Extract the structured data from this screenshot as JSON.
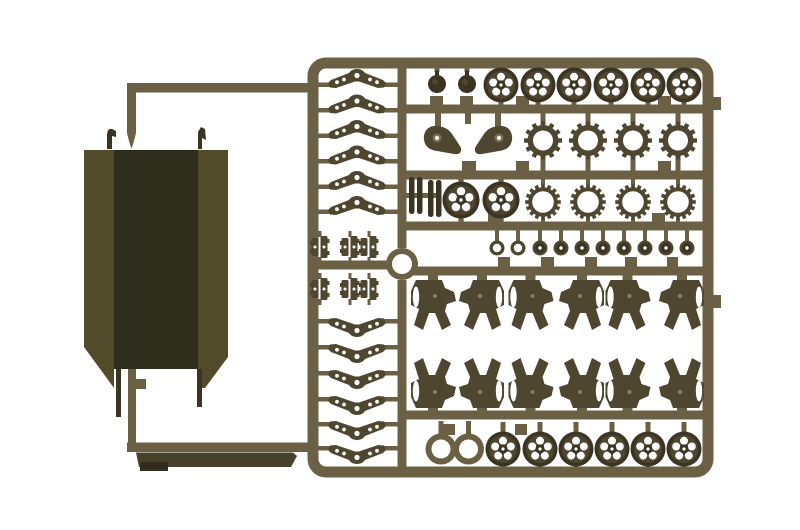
{
  "scene": {
    "description": "Photograph of an olive-drab injection-molded model kit sprue (parts tree) holding tank running-gear parts, with a separate dark hull tub attached to the frame by feed runners on a white background",
    "background_color": "#ffffff"
  },
  "colors": {
    "background": "#ffffff",
    "runner": "#6b6044",
    "runner_light": "#7b7052",
    "part": "#4f4630",
    "part_dark": "#3c3422",
    "bolt": "#8c7f5c",
    "hull_wall": "#514b29",
    "hull_interior": "#2e2c1b",
    "hull_leg": "#3a3522",
    "floor_part": "#45412a",
    "floor_tab": "#302d1d",
    "hole": "#ffffff"
  },
  "inventory": {
    "hull_tub": 1,
    "hull_floor_strip": 1,
    "chevron_spring_arms": 12,
    "bracket_clusters": 6,
    "return_roller_domes": 2,
    "road_wheels": 12,
    "idler_wheels": 2,
    "drive_sprockets": 4,
    "toothed_sprocket_rings": 4,
    "final_drive_housings": 2,
    "shock_absorbers": 4,
    "bogie_brackets": 12,
    "hub_caps": 8,
    "hub_rings": 2,
    "wheel_rims": 2,
    "locator_ring": 1
  }
}
